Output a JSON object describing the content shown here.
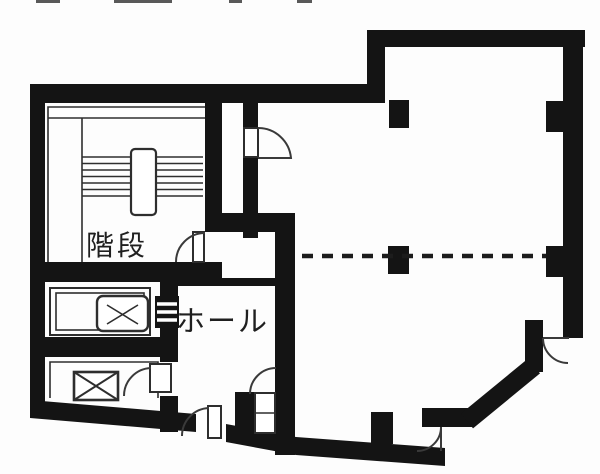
{
  "document": {
    "kind": "floor-plan",
    "language": "ja"
  },
  "labels": {
    "stairs": "階段",
    "hall": "ホール"
  },
  "colors": {
    "wall": "#141414",
    "background": "#fdfdfd",
    "thin_line": "#2e2e2e",
    "label_text": "#1f1f1f"
  },
  "symbols": {
    "stairs": "parallel-tread-lines-with-newel",
    "elevator": "rounded-box-with-cross-marks",
    "shaft": "box-with-x",
    "door": "quarter-circle-swing-arc",
    "pillar": "solid-black-square",
    "partition": "dashed-line"
  }
}
